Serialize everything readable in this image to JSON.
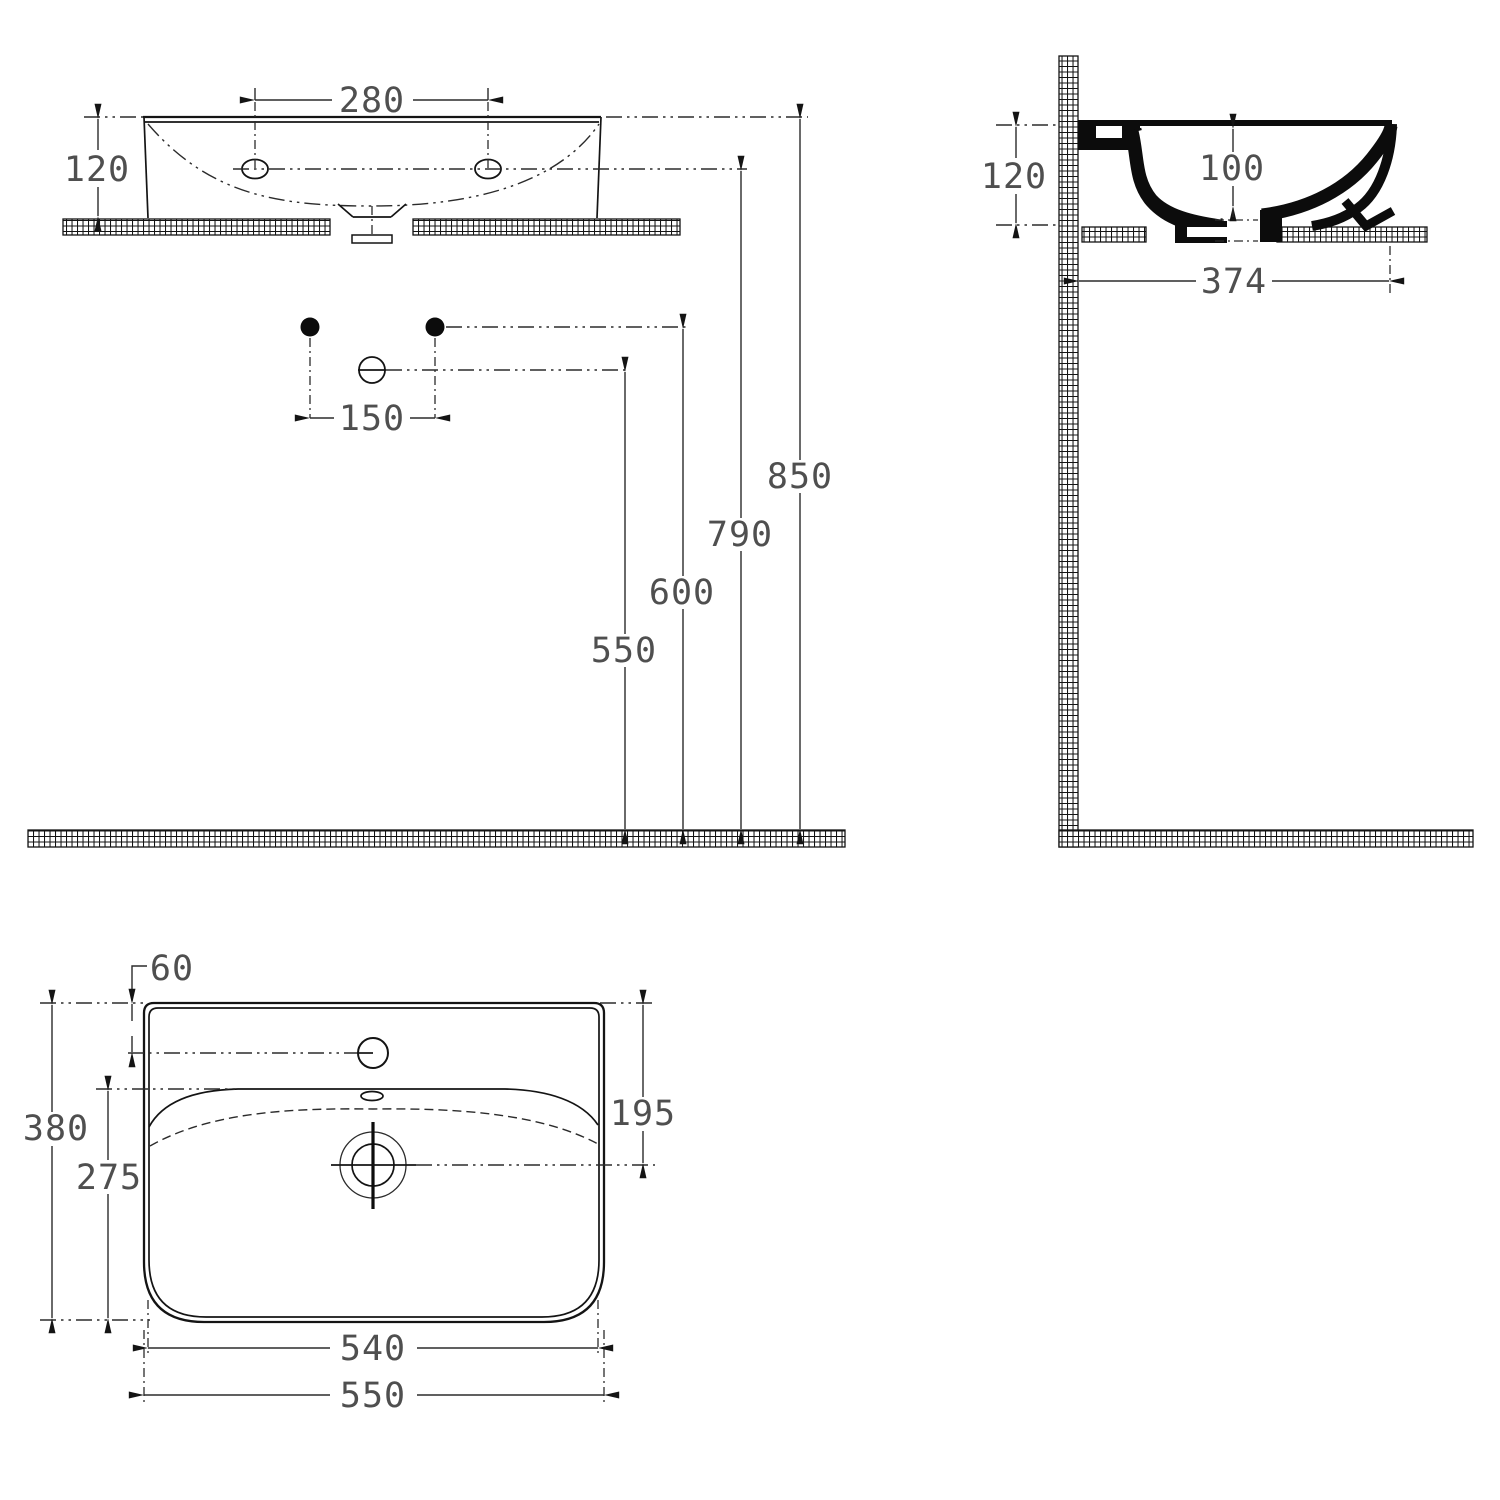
{
  "drawing_title": "washbasin-technical-drawing-three-views",
  "colors": {
    "line": "#141414",
    "dim_text": "#4f4f4f",
    "background": "#ffffff"
  },
  "views": {
    "front": {
      "label": "front-view",
      "dims": {
        "hole_spacing": "280",
        "height": "120",
        "tap_hole_spacing": "150",
        "drain_outlet_height": "550",
        "supply_height": "600",
        "fixing_hole_height": "790",
        "rim_height": "850"
      }
    },
    "side": {
      "label": "side-view",
      "dims": {
        "height": "120",
        "bowl_depth": "100",
        "projection": "374"
      }
    },
    "plan": {
      "label": "plan-view",
      "dims": {
        "tap_hole_offset": "60",
        "overall_depth": "380",
        "bowl_length": "275",
        "drain_offset": "195",
        "inner_width": "540",
        "overall_width": "550"
      }
    }
  }
}
